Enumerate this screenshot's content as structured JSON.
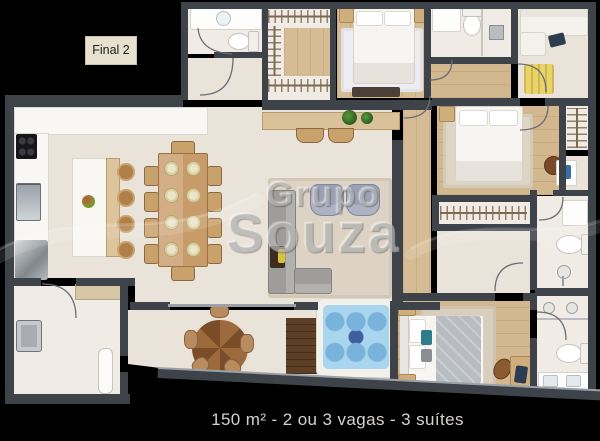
{
  "label": {
    "text": "Final 2"
  },
  "watermark": {
    "line1": "Grupo",
    "line2": "Souza"
  },
  "caption": {
    "text": "150 m² - 2 ou 3 vagas - 3 suítes"
  },
  "colors": {
    "background": "#000000",
    "wall": "#3e434a",
    "floor_beige": "#e9e3da",
    "wood_floor": "#d6bc94",
    "deck_wood": "#5d3f26",
    "hot_tub_water": "#a9d6ee",
    "label_bg": "#e8e1cd",
    "caption_text": "#d6d2cd",
    "office_rug": "#e8d468"
  }
}
